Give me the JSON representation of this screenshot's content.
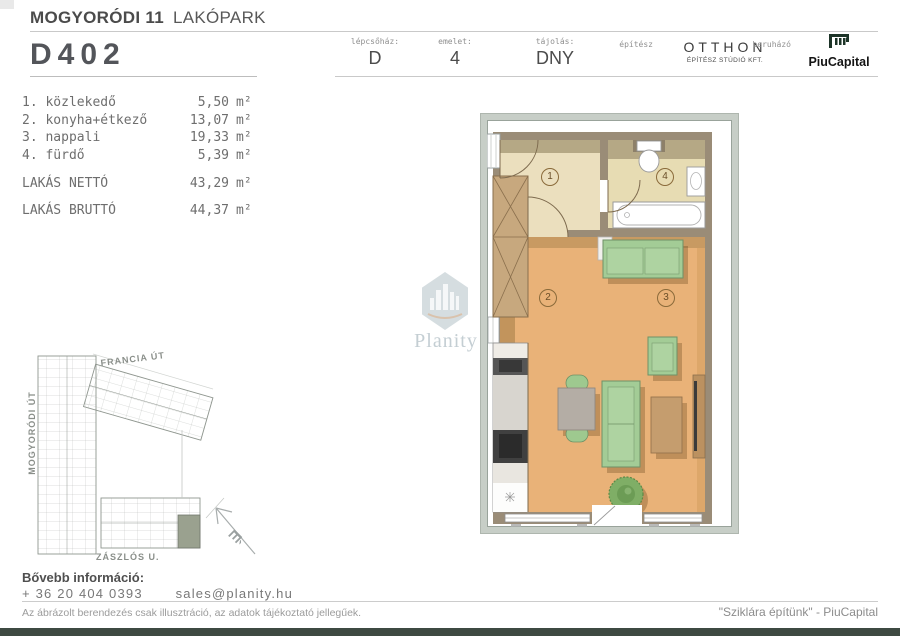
{
  "header": {
    "project_bold": "MOGYORÓDI 11",
    "project_light": "LAKÓPARK",
    "unit_id": "D402"
  },
  "info": {
    "fields": [
      {
        "label": "lépcsőház:",
        "value": "D"
      },
      {
        "label": "emelet:",
        "value": "4"
      },
      {
        "label": "tájolás:",
        "value": "DNY"
      }
    ],
    "architect": {
      "label": "építész",
      "name": "OTTHON",
      "subtitle": "ÉPÍTÉSZ STÚDIÓ KFT."
    },
    "developer": {
      "label": "beruházó",
      "name": "PiuCapital"
    }
  },
  "rooms": {
    "list": [
      {
        "num": "1. ",
        "name": "közlekedő",
        "area": "5,50"
      },
      {
        "num": "2. ",
        "name": "konyha+étkező",
        "area": "13,07"
      },
      {
        "num": "3. ",
        "name": "nappali",
        "area": "19,33"
      },
      {
        "num": "4. ",
        "name": "fürdő",
        "area": "5,39"
      }
    ],
    "unit": "m²",
    "totals": [
      {
        "label": "LAKÁS NETTÓ",
        "area": "43,29"
      },
      {
        "label": "LAKÁS BRUTTÓ",
        "area": "44,37"
      }
    ]
  },
  "floorplan": {
    "numbers": [
      "1",
      "2",
      "3",
      "4"
    ]
  },
  "siteplan": {
    "streets": {
      "top": "FRANCIA ÚT",
      "left": "MOGYORÓDI ÚT",
      "bottom": "ZÁSZLÓS U."
    },
    "compass": "É"
  },
  "watermark": {
    "brand": "Planity"
  },
  "footer": {
    "info_label": "Bővebb információ:",
    "phone": "+ 36 20 404 0393",
    "email": "sales@planity.hu",
    "disclaimer": "Az ábrázolt berendezés csak illusztráció, az adatok tájékoztató jellegűek.",
    "slogan": "\"Sziklára építünk\" - PiuCapital"
  },
  "colors": {
    "bottom_bar": "#3e4a42",
    "brand_green": "#1d3428",
    "wood_floor": "#e9b278",
    "tile_floor": "#ebdfbe",
    "wall": "#9a8c77",
    "furniture_green": "#a3cc96",
    "site_highlight": "#9aa18f"
  }
}
